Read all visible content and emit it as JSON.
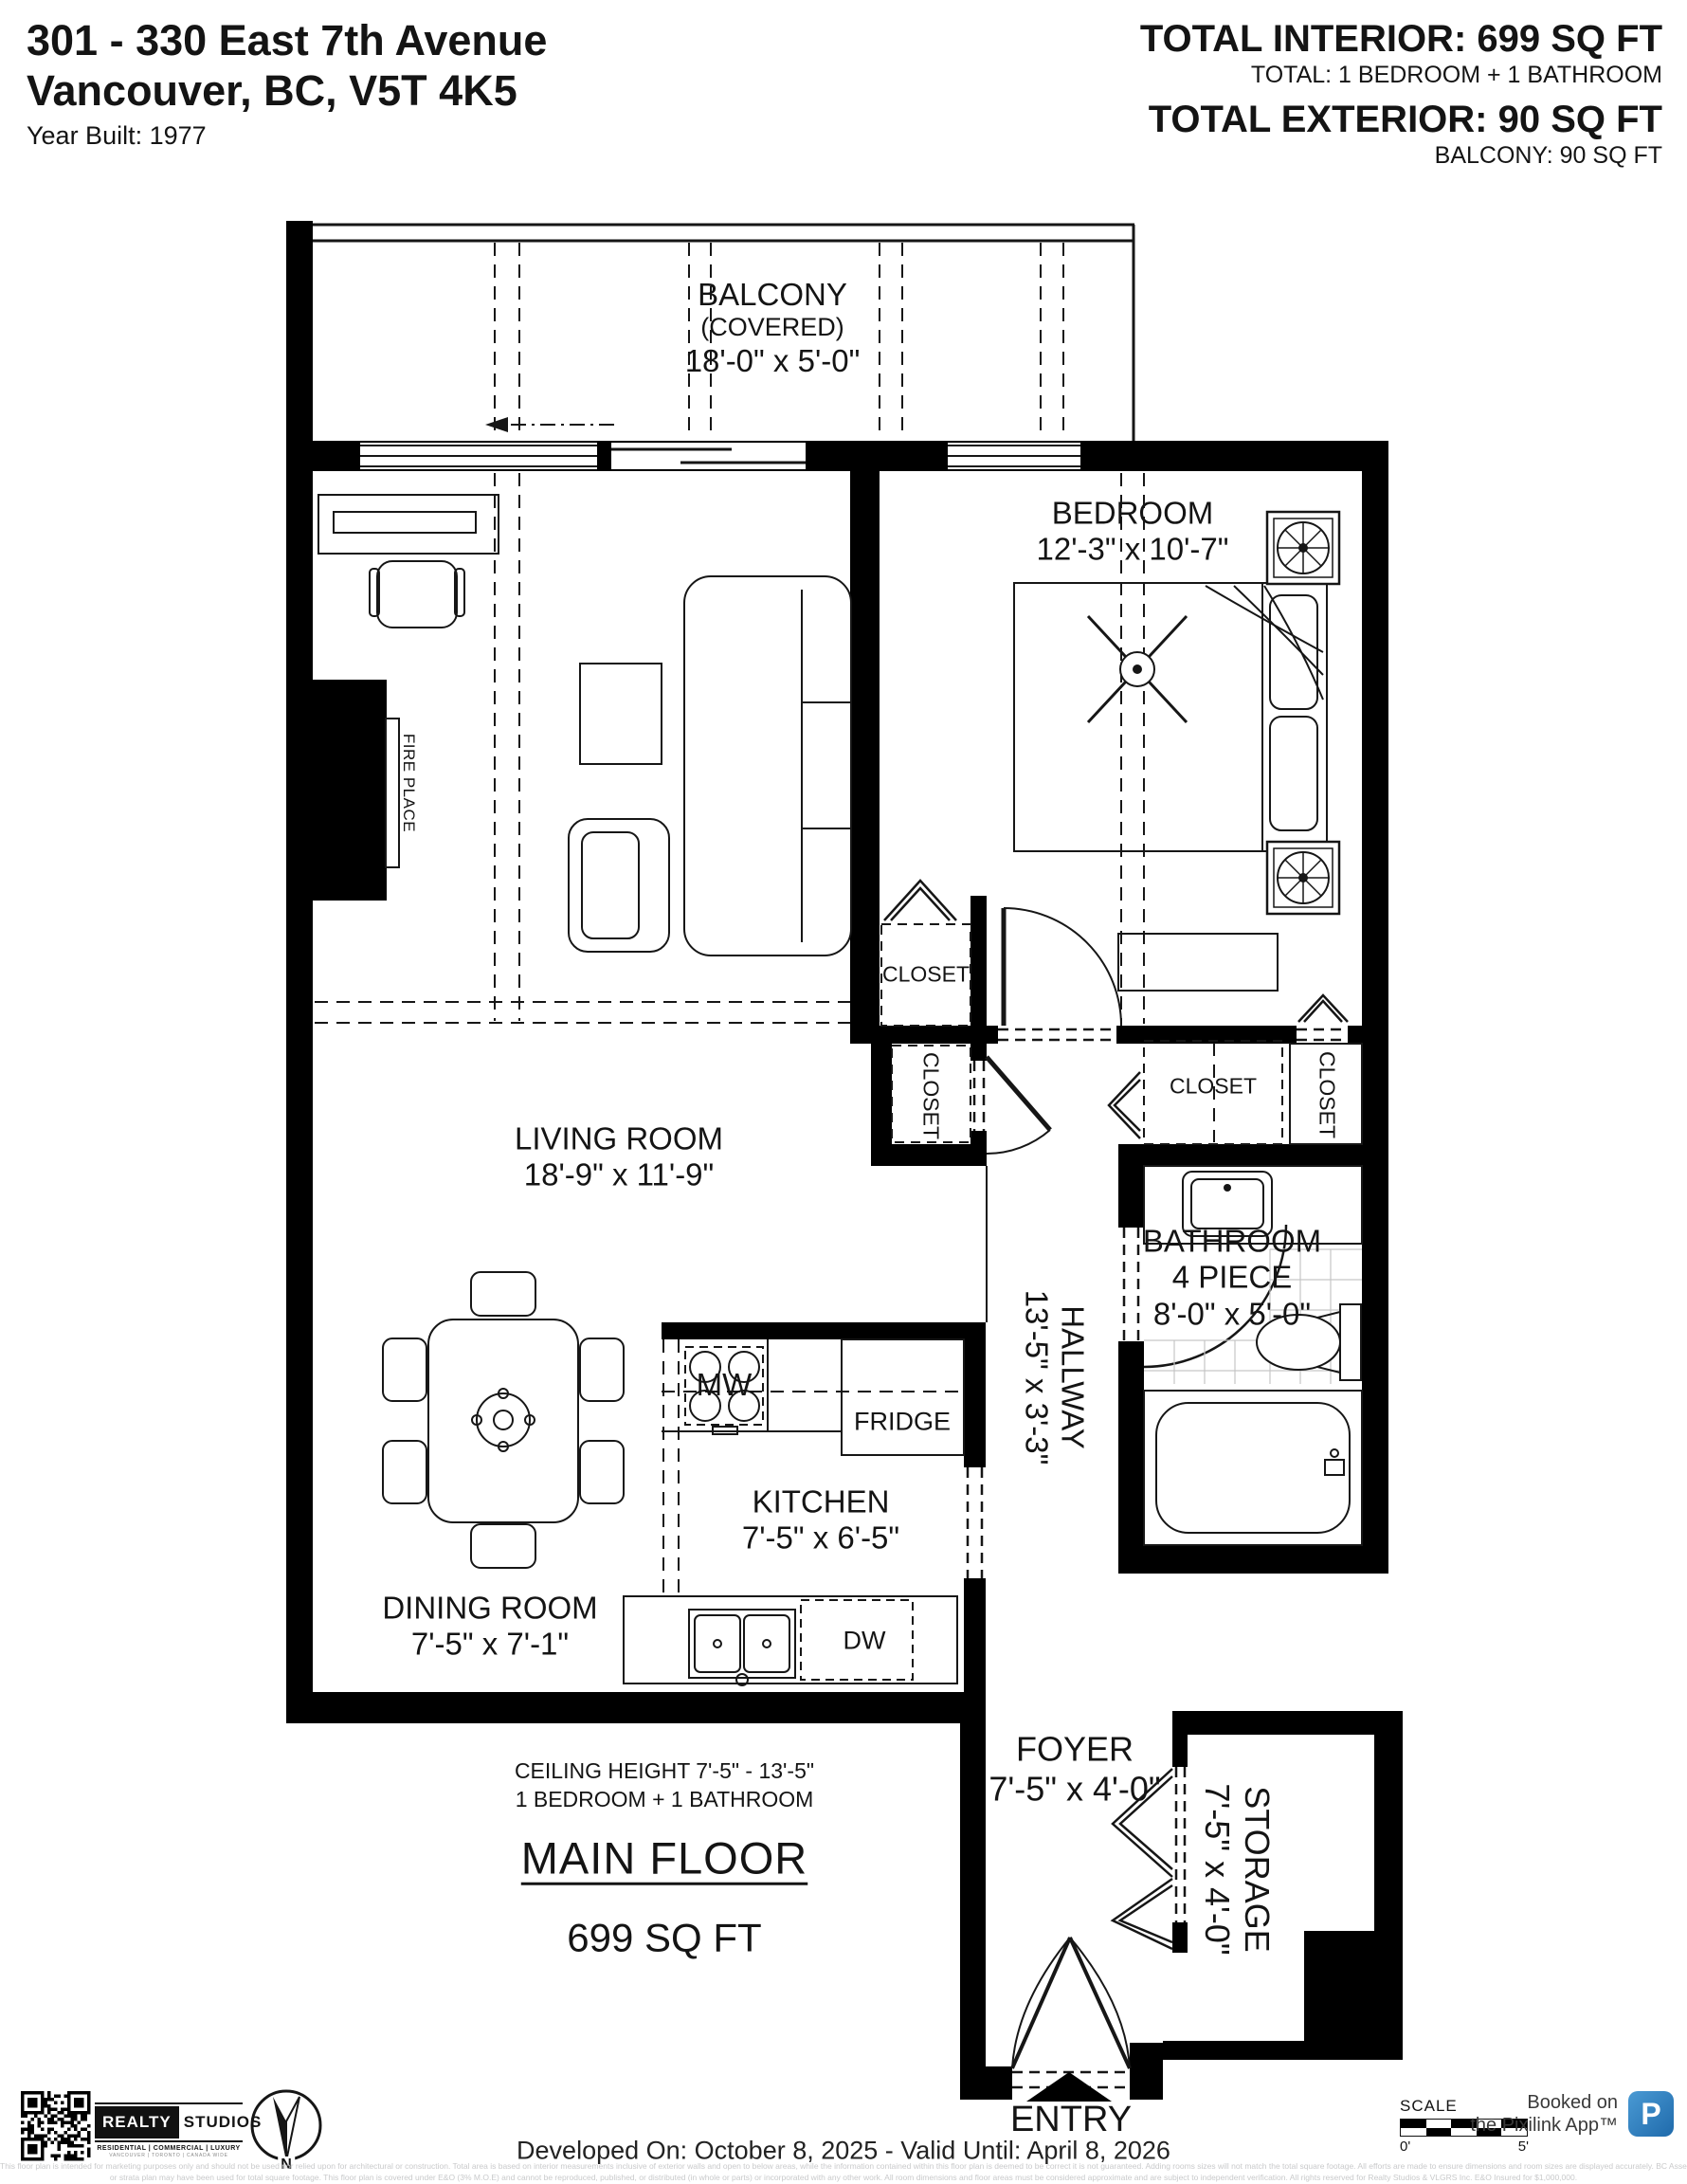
{
  "header": {
    "address_line1": "301 - 330 East 7th Avenue",
    "address_line2": "Vancouver, BC, V5T 4K5",
    "year_built": "Year Built: 1977",
    "total_interior": "TOTAL INTERIOR: 699 SQ FT",
    "total_interior_sub": "TOTAL: 1 BEDROOM + 1 BATHROOM",
    "total_exterior": "TOTAL EXTERIOR: 90 SQ FT",
    "total_exterior_sub": "BALCONY: 90 SQ FT"
  },
  "rooms": {
    "balcony": {
      "name": "BALCONY",
      "note": "(COVERED)",
      "dims": "18'-0\" x 5'-0\""
    },
    "bedroom": {
      "name": "BEDROOM",
      "dims": "12'-3\" x 10'-7\""
    },
    "living_room": {
      "name": "LIVING ROOM",
      "dims": "18'-9\" x 11'-9\""
    },
    "dining_room": {
      "name": "DINING ROOM",
      "dims": "7'-5\" x 7'-1\""
    },
    "kitchen": {
      "name": "KITCHEN",
      "dims": "7'-5\" x 6'-5\""
    },
    "hallway": {
      "name": "HALLWAY",
      "dims": "13'-5\" x 3'-3\""
    },
    "bathroom": {
      "name": "BATHROOM",
      "type": "4 PIECE",
      "dims": "8'-0\" x 5'-0\""
    },
    "foyer": {
      "name": "FOYER",
      "dims": "7'-5\" x 4'-0\""
    },
    "storage": {
      "name": "STORAGE",
      "dims": "7'-5\" x 4'-0\""
    },
    "closet_label": "CLOSET",
    "fireplace_label": "FIRE PLACE",
    "entry_label": "ENTRY"
  },
  "appliances": {
    "microwave": "MW",
    "fridge": "FRIDGE",
    "dishwasher": "DW"
  },
  "summary": {
    "ceiling_height": "CEILING HEIGHT 7'-5\" - 13'-5\"",
    "configuration": "1 BEDROOM + 1 BATHROOM",
    "floor_name": "MAIN FLOOR",
    "floor_area": "699 SQ FT"
  },
  "footer": {
    "developed": "Developed On: October 8, 2025 - Valid Until: April 8, 2026",
    "brand": {
      "name_left": "REALTY",
      "name_right": "STUDIOS",
      "tagline": "RESIDENTIAL | COMMERCIAL | LUXURY",
      "cities": "VANCOUVER | TORONTO | CANADA WIDE"
    },
    "compass_letter": "N",
    "scale": {
      "label": "SCALE",
      "start": "0'",
      "end": "5'"
    },
    "pixilink": {
      "line1": "Booked on",
      "line2": "the Pixilink App™",
      "logo_letter": "P",
      "logo_color": "#2b7fc4"
    },
    "disclaimer_line1": "This floor plan is intended for marketing purposes only and should not be used nor relied upon for architectural or construction. Total area is based on interior measurements inclusive of exterior walls and open to below areas, while the information contained within this floor plan is deemed to be correct it is not guaranteed. Adding rooms sizes will not match the total square footage. All efforts are made to ensure dimensions and room sizes are displayed accurately. BC Assessment",
    "disclaimer_line2": "or strata plan may have been used for total square footage. This floor plan is covered under E&O (3% M.O.E) and cannot be reproduced, published, or distributed (in whole or parts) or incorporated with any other work. All room dimensions and floor areas must be considered approximate and are subject to independent verification. All rights reserved for Realty Studios & VLGRS Inc. E&O Insured for $1,000,000."
  },
  "colors": {
    "walls": "#000000",
    "ink": "#161616",
    "tile_grid": "#c6c6c6",
    "disclaimer": "#c9cacb",
    "pixilink_blue": "#2b7fc4"
  }
}
